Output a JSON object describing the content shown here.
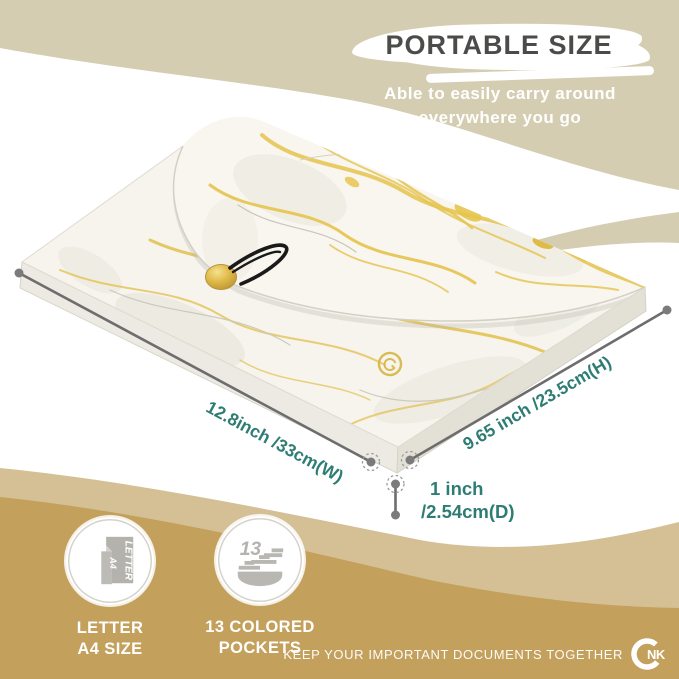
{
  "header": {
    "title": "PORTABLE SIZE",
    "subtitle_line1": "Able to easily carry around",
    "subtitle_line2": "everywhere you go"
  },
  "dimensions": {
    "width": "12.8inch /33cm(W)",
    "height": "9.65 inch /23.5cm(H)",
    "depth_line1": "1 inch",
    "depth_line2": "/2.54cm(D)"
  },
  "features": [
    {
      "icon": "letter-a4-icon",
      "icon_text_primary": "LETTER",
      "icon_text_secondary": "A4",
      "label_line1": "LETTER",
      "label_line2": "A4 SIZE"
    },
    {
      "icon": "pockets-icon",
      "icon_text_primary": "13",
      "label_line1": "13 COLORED",
      "label_line2": "POCKETS"
    }
  ],
  "footer": {
    "tagline": "KEEP YOUR IMPORTANT DOCUMENTS TOGETHER",
    "logo_text": "NK"
  },
  "colors": {
    "teal": "#2e7d74",
    "beige": "#d5cdb2",
    "wave_light": "#d4c094",
    "wave_dark": "#c3a05c",
    "line_gray": "#6d6d6d",
    "title_gray": "#4b4b4a",
    "marble_gold": "#e4c24b",
    "button_gold": "#d9b440"
  }
}
